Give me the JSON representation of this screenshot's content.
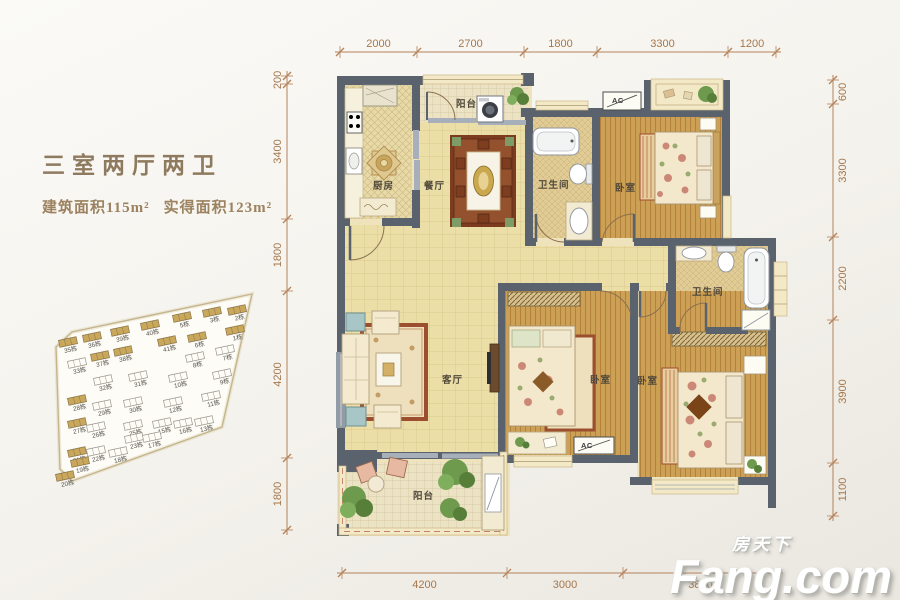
{
  "header": {
    "layout_title": "三室两厅两卫",
    "built_area": "建筑面积115m²",
    "actual_area": "实得面积123m²"
  },
  "watermark": {
    "brand_cn": "房天下",
    "brand_en": "Fang.com"
  },
  "dimensions": {
    "top": [
      "2000",
      "2700",
      "1800",
      "3300",
      "1200"
    ],
    "left": [
      "200",
      "3400",
      "1800",
      "4200",
      "1800"
    ],
    "right": [
      "600",
      "3300",
      "2200",
      "3900",
      "1100"
    ],
    "bottom": [
      "4200",
      "3000",
      "3800"
    ]
  },
  "rooms": [
    {
      "id": "kitchen",
      "label": "厨房"
    },
    {
      "id": "dining",
      "label": "餐厅"
    },
    {
      "id": "balcony-top",
      "label": "阳台"
    },
    {
      "id": "bath-1",
      "label": "卫生间"
    },
    {
      "id": "bedroom-top-right",
      "label": "卧室"
    },
    {
      "id": "living",
      "label": "客厅"
    },
    {
      "id": "bedroom-middle",
      "label": "卧室"
    },
    {
      "id": "bath-2",
      "label": "卫生间"
    },
    {
      "id": "bedroom-master",
      "label": "卧室"
    },
    {
      "id": "balcony-bottom",
      "label": "阳台"
    }
  ],
  "ac_units": [
    {
      "label": "AC"
    },
    {
      "label": "AC"
    }
  ],
  "site_plan": {
    "buildings": [
      {
        "label": "2栋",
        "x": 237,
        "y": 310,
        "filled": true
      },
      {
        "label": "3栋",
        "x": 212,
        "y": 312,
        "filled": true
      },
      {
        "label": "5栋",
        "x": 182,
        "y": 317,
        "filled": true
      },
      {
        "label": "40栋",
        "x": 150,
        "y": 325,
        "filled": true
      },
      {
        "label": "39栋",
        "x": 120,
        "y": 331,
        "filled": true
      },
      {
        "label": "36栋",
        "x": 92,
        "y": 337,
        "filled": true
      },
      {
        "label": "35栋",
        "x": 68,
        "y": 342,
        "filled": true
      },
      {
        "label": "1栋",
        "x": 235,
        "y": 330,
        "filled": true
      },
      {
        "label": "6栋",
        "x": 197,
        "y": 337,
        "filled": true
      },
      {
        "label": "41栋",
        "x": 167,
        "y": 341,
        "filled": true
      },
      {
        "label": "7栋",
        "x": 225,
        "y": 350,
        "filled": false
      },
      {
        "label": "38栋",
        "x": 123,
        "y": 351,
        "filled": true
      },
      {
        "label": "37栋",
        "x": 100,
        "y": 356,
        "filled": true
      },
      {
        "label": "33栋",
        "x": 77,
        "y": 363,
        "filled": false
      },
      {
        "label": "8栋",
        "x": 195,
        "y": 357,
        "filled": false
      },
      {
        "label": "9栋",
        "x": 222,
        "y": 374,
        "filled": false
      },
      {
        "label": "32栋",
        "x": 103,
        "y": 380,
        "filled": false
      },
      {
        "label": "31栋",
        "x": 138,
        "y": 376,
        "filled": false
      },
      {
        "label": "10栋",
        "x": 178,
        "y": 377,
        "filled": false
      },
      {
        "label": "28栋",
        "x": 77,
        "y": 400,
        "filled": true
      },
      {
        "label": "29栋",
        "x": 102,
        "y": 405,
        "filled": false
      },
      {
        "label": "30栋",
        "x": 133,
        "y": 402,
        "filled": false
      },
      {
        "label": "12栋",
        "x": 173,
        "y": 402,
        "filled": false
      },
      {
        "label": "11栋",
        "x": 211,
        "y": 396,
        "filled": false
      },
      {
        "label": "27栋",
        "x": 77,
        "y": 423,
        "filled": true
      },
      {
        "label": "26栋",
        "x": 96,
        "y": 427,
        "filled": false
      },
      {
        "label": "25栋",
        "x": 133,
        "y": 425,
        "filled": false
      },
      {
        "label": "15栋",
        "x": 162,
        "y": 423,
        "filled": false
      },
      {
        "label": "16栋",
        "x": 183,
        "y": 423,
        "filled": false
      },
      {
        "label": "13栋",
        "x": 204,
        "y": 421,
        "filled": false
      },
      {
        "label": "23栋",
        "x": 134,
        "y": 438,
        "filled": false
      },
      {
        "label": "17栋",
        "x": 152,
        "y": 437,
        "filled": false
      },
      {
        "label": "21栋",
        "x": 77,
        "y": 452,
        "filled": true
      },
      {
        "label": "22栋",
        "x": 96,
        "y": 451,
        "filled": false
      },
      {
        "label": "18栋",
        "x": 118,
        "y": 452,
        "filled": false
      },
      {
        "label": "19栋",
        "x": 80,
        "y": 462,
        "filled": true
      },
      {
        "label": "20栋",
        "x": 65,
        "y": 476,
        "filled": true
      }
    ]
  },
  "colors": {
    "wall": "#59626d",
    "dim_line": "#b5825a",
    "dim_text": "#a5774c",
    "wood_floor": "#cda155",
    "tile_floor": "#ebdfa7",
    "bath_floor": "#e2cc95",
    "kitchen_floor": "#e7d9a8",
    "balcony_floor": "#ece3c4",
    "window_sill": "#f4e9c6",
    "rug_red": "#8a4527",
    "plant_green": "#6d9a4c",
    "building_tan": "#c9a85c",
    "title_text": "#8e7a5e"
  }
}
